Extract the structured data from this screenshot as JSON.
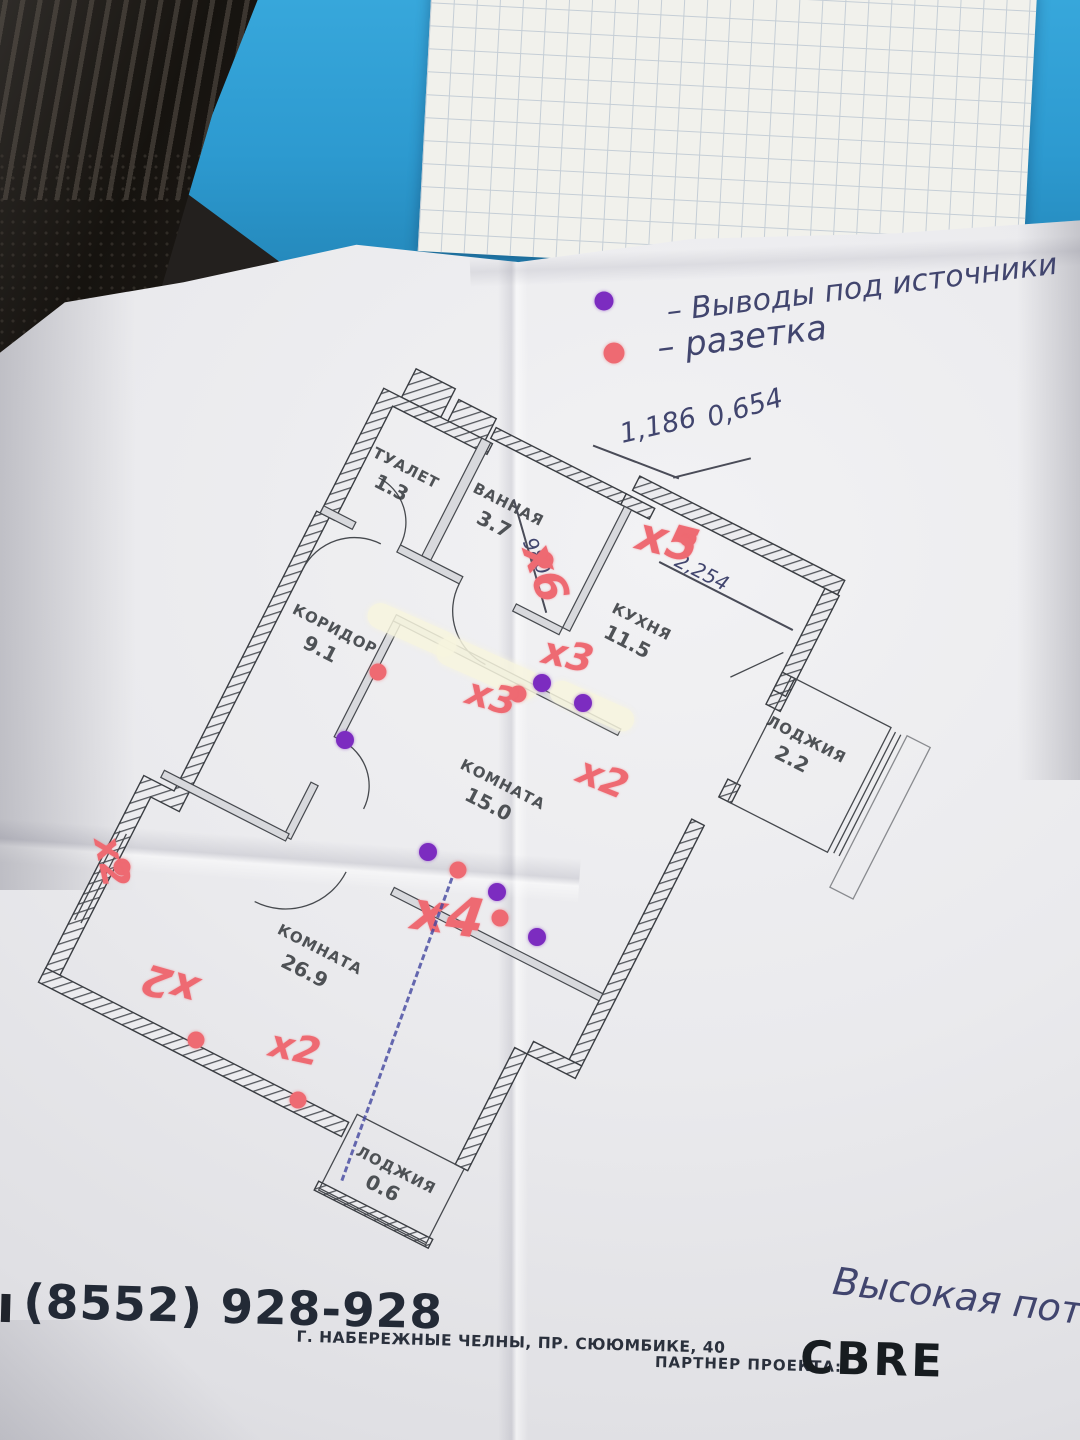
{
  "legend": {
    "item1": {
      "label": "– Выводы под источники"
    },
    "item2": {
      "label": "– разетка"
    }
  },
  "plan": {
    "rooms": [
      {
        "name": "ТУАЛЕТ",
        "area": "1.3"
      },
      {
        "name": "ВАННАЯ",
        "area": "3.7"
      },
      {
        "name": "КУХНЯ",
        "area": "11.5"
      },
      {
        "name": "КОРИДОР",
        "area": "9.1"
      },
      {
        "name": "КОМНАТА",
        "area": "15.0"
      },
      {
        "name": "ЛОДЖИЯ",
        "area": "2.2"
      },
      {
        "name": "КОМНАТА",
        "area": "26.9"
      },
      {
        "name": "ЛОДЖИЯ",
        "area": "0.6"
      }
    ]
  },
  "annotations": {
    "dimensions": {
      "width1": "1,186",
      "width2": "0,654",
      "height_left": "980",
      "kitchen_width": "2,254"
    },
    "markers": [
      {
        "label": "x6"
      },
      {
        "label": "x5"
      },
      {
        "label": "x3"
      },
      {
        "label": "x3"
      },
      {
        "label": "x2"
      },
      {
        "label": "x4"
      },
      {
        "label": "x2"
      },
      {
        "label": "x2"
      },
      {
        "label": "x2"
      }
    ],
    "note": "Высокая пот"
  },
  "footer": {
    "phone": "(8552) 928-928",
    "address": "Г. НАБЕРЕЖНЫЕ ЧЕЛНЫ, ПР. СЮЮМБИКЕ, 40",
    "partner_label": "ПАРТНЕР ПРОЕКТА:",
    "partner_name": "CBRE"
  },
  "colors": {
    "marker_red": "#ee6a72",
    "outlet_purple": "#7c2cc0",
    "pen_ink": "#41456e",
    "folder_blue": "#2e9ed4"
  }
}
